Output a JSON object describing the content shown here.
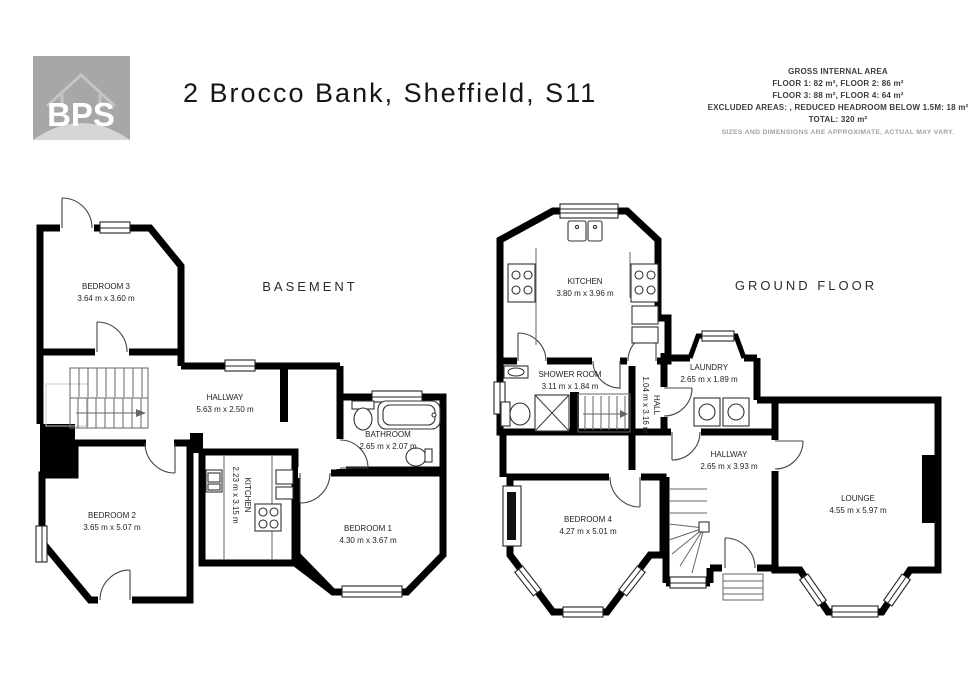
{
  "header": {
    "logo_text": "BPS",
    "title": "2 Brocco Bank, Sheffield, S11",
    "area_summary": {
      "heading": "GROSS INTERNAL AREA",
      "line_floor12": "FLOOR 1: 82 m², FLOOR 2: 86 m²",
      "line_floor34": "FLOOR 3: 88 m², FLOOR 4: 64 m²",
      "line_excluded": "EXCLUDED AREAS: , REDUCED HEADROOM BELOW 1.5M: 18 m²",
      "line_total": "TOTAL: 320 m²",
      "disclaimer": "SIZES AND DIMENSIONS ARE APPROXIMATE, ACTUAL MAY VARY."
    }
  },
  "floors": [
    {
      "label": "BASEMENT",
      "rooms": [
        {
          "name": "BEDROOM 3",
          "dims": "3.64 m x 3.60 m"
        },
        {
          "name": "HALLWAY",
          "dims": "5.63 m x 2.50 m"
        },
        {
          "name": "BATHROOM",
          "dims": "2.65 m x 2.07 m"
        },
        {
          "name": "KITCHEN",
          "dims": "2.23 m x 3.15 m"
        },
        {
          "name": "BEDROOM 2",
          "dims": "3.65 m x 5.07 m"
        },
        {
          "name": "BEDROOM 1",
          "dims": "4.30 m x 3.67 m"
        }
      ]
    },
    {
      "label": "GROUND FLOOR",
      "rooms": [
        {
          "name": "KITCHEN",
          "dims": "3.80 m x 3.96 m"
        },
        {
          "name": "SHOWER ROOM",
          "dims": "3.11 m x 1.84 m"
        },
        {
          "name": "HALL",
          "dims": "1.04 m x 3.16 m"
        },
        {
          "name": "LAUNDRY",
          "dims": "2.65 m x 1.89 m"
        },
        {
          "name": "HALLWAY",
          "dims": "2.65 m x 3.93 m"
        },
        {
          "name": "BEDROOM 4",
          "dims": "4.27 m x 5.01 m"
        },
        {
          "name": "LOUNGE",
          "dims": "4.55 m x 5.97 m"
        }
      ]
    }
  ]
}
